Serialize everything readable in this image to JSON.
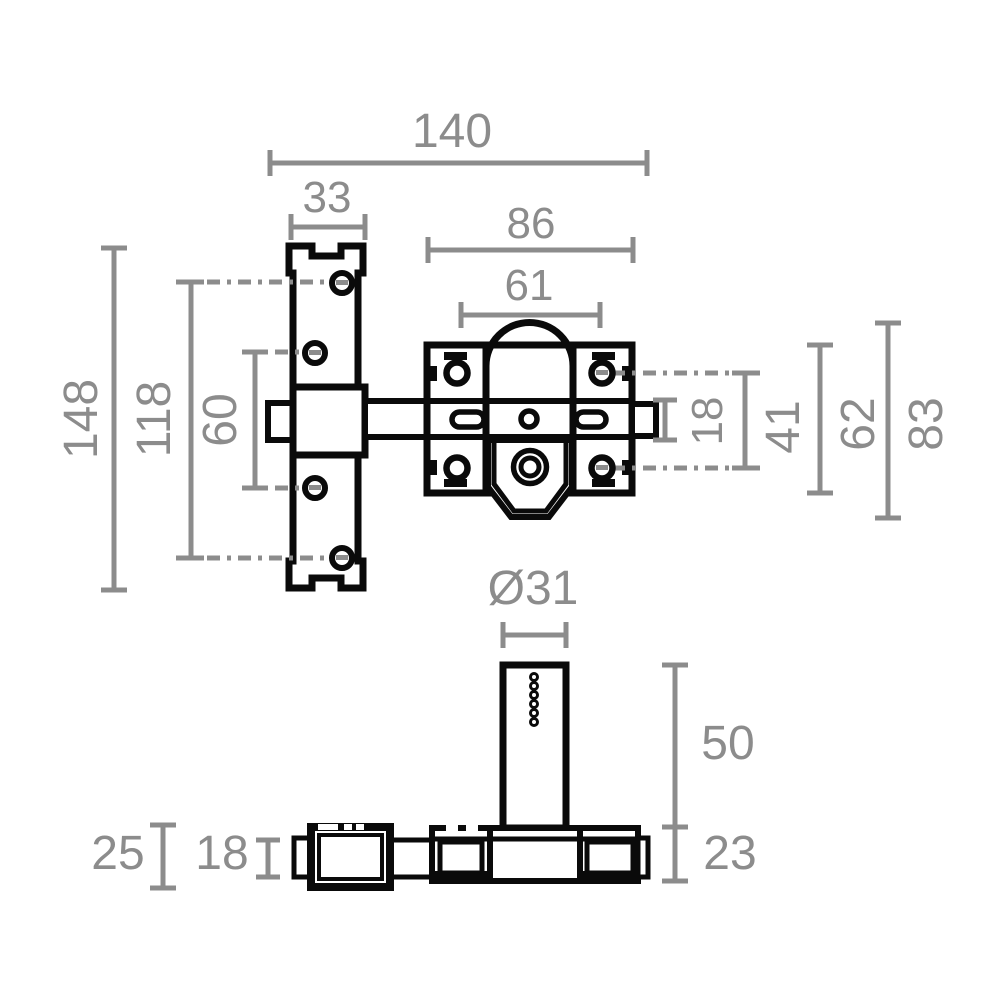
{
  "drawing": {
    "background": "#ffffff",
    "outline_color": "#0a0a0a",
    "dimension_color": "#8c8c8c",
    "views": {
      "front": "front view of bolt lock with strike plate",
      "bottom": "bottom view with cylinder"
    },
    "dims": {
      "total_length": "140",
      "keep_width": "33",
      "body_width": "86",
      "screw_span_width": "61",
      "keep_height": "148",
      "keep_hole_span_outer": "118",
      "keep_hole_span_inner": "60",
      "bolt_height": "18",
      "screw_span_height": "41",
      "body_height": "62",
      "body_total_height": "83",
      "cylinder_diameter": "Ø31",
      "cylinder_length": "50",
      "body_depth": "23",
      "keep_depth": "25",
      "bolt_depth": "18"
    }
  }
}
